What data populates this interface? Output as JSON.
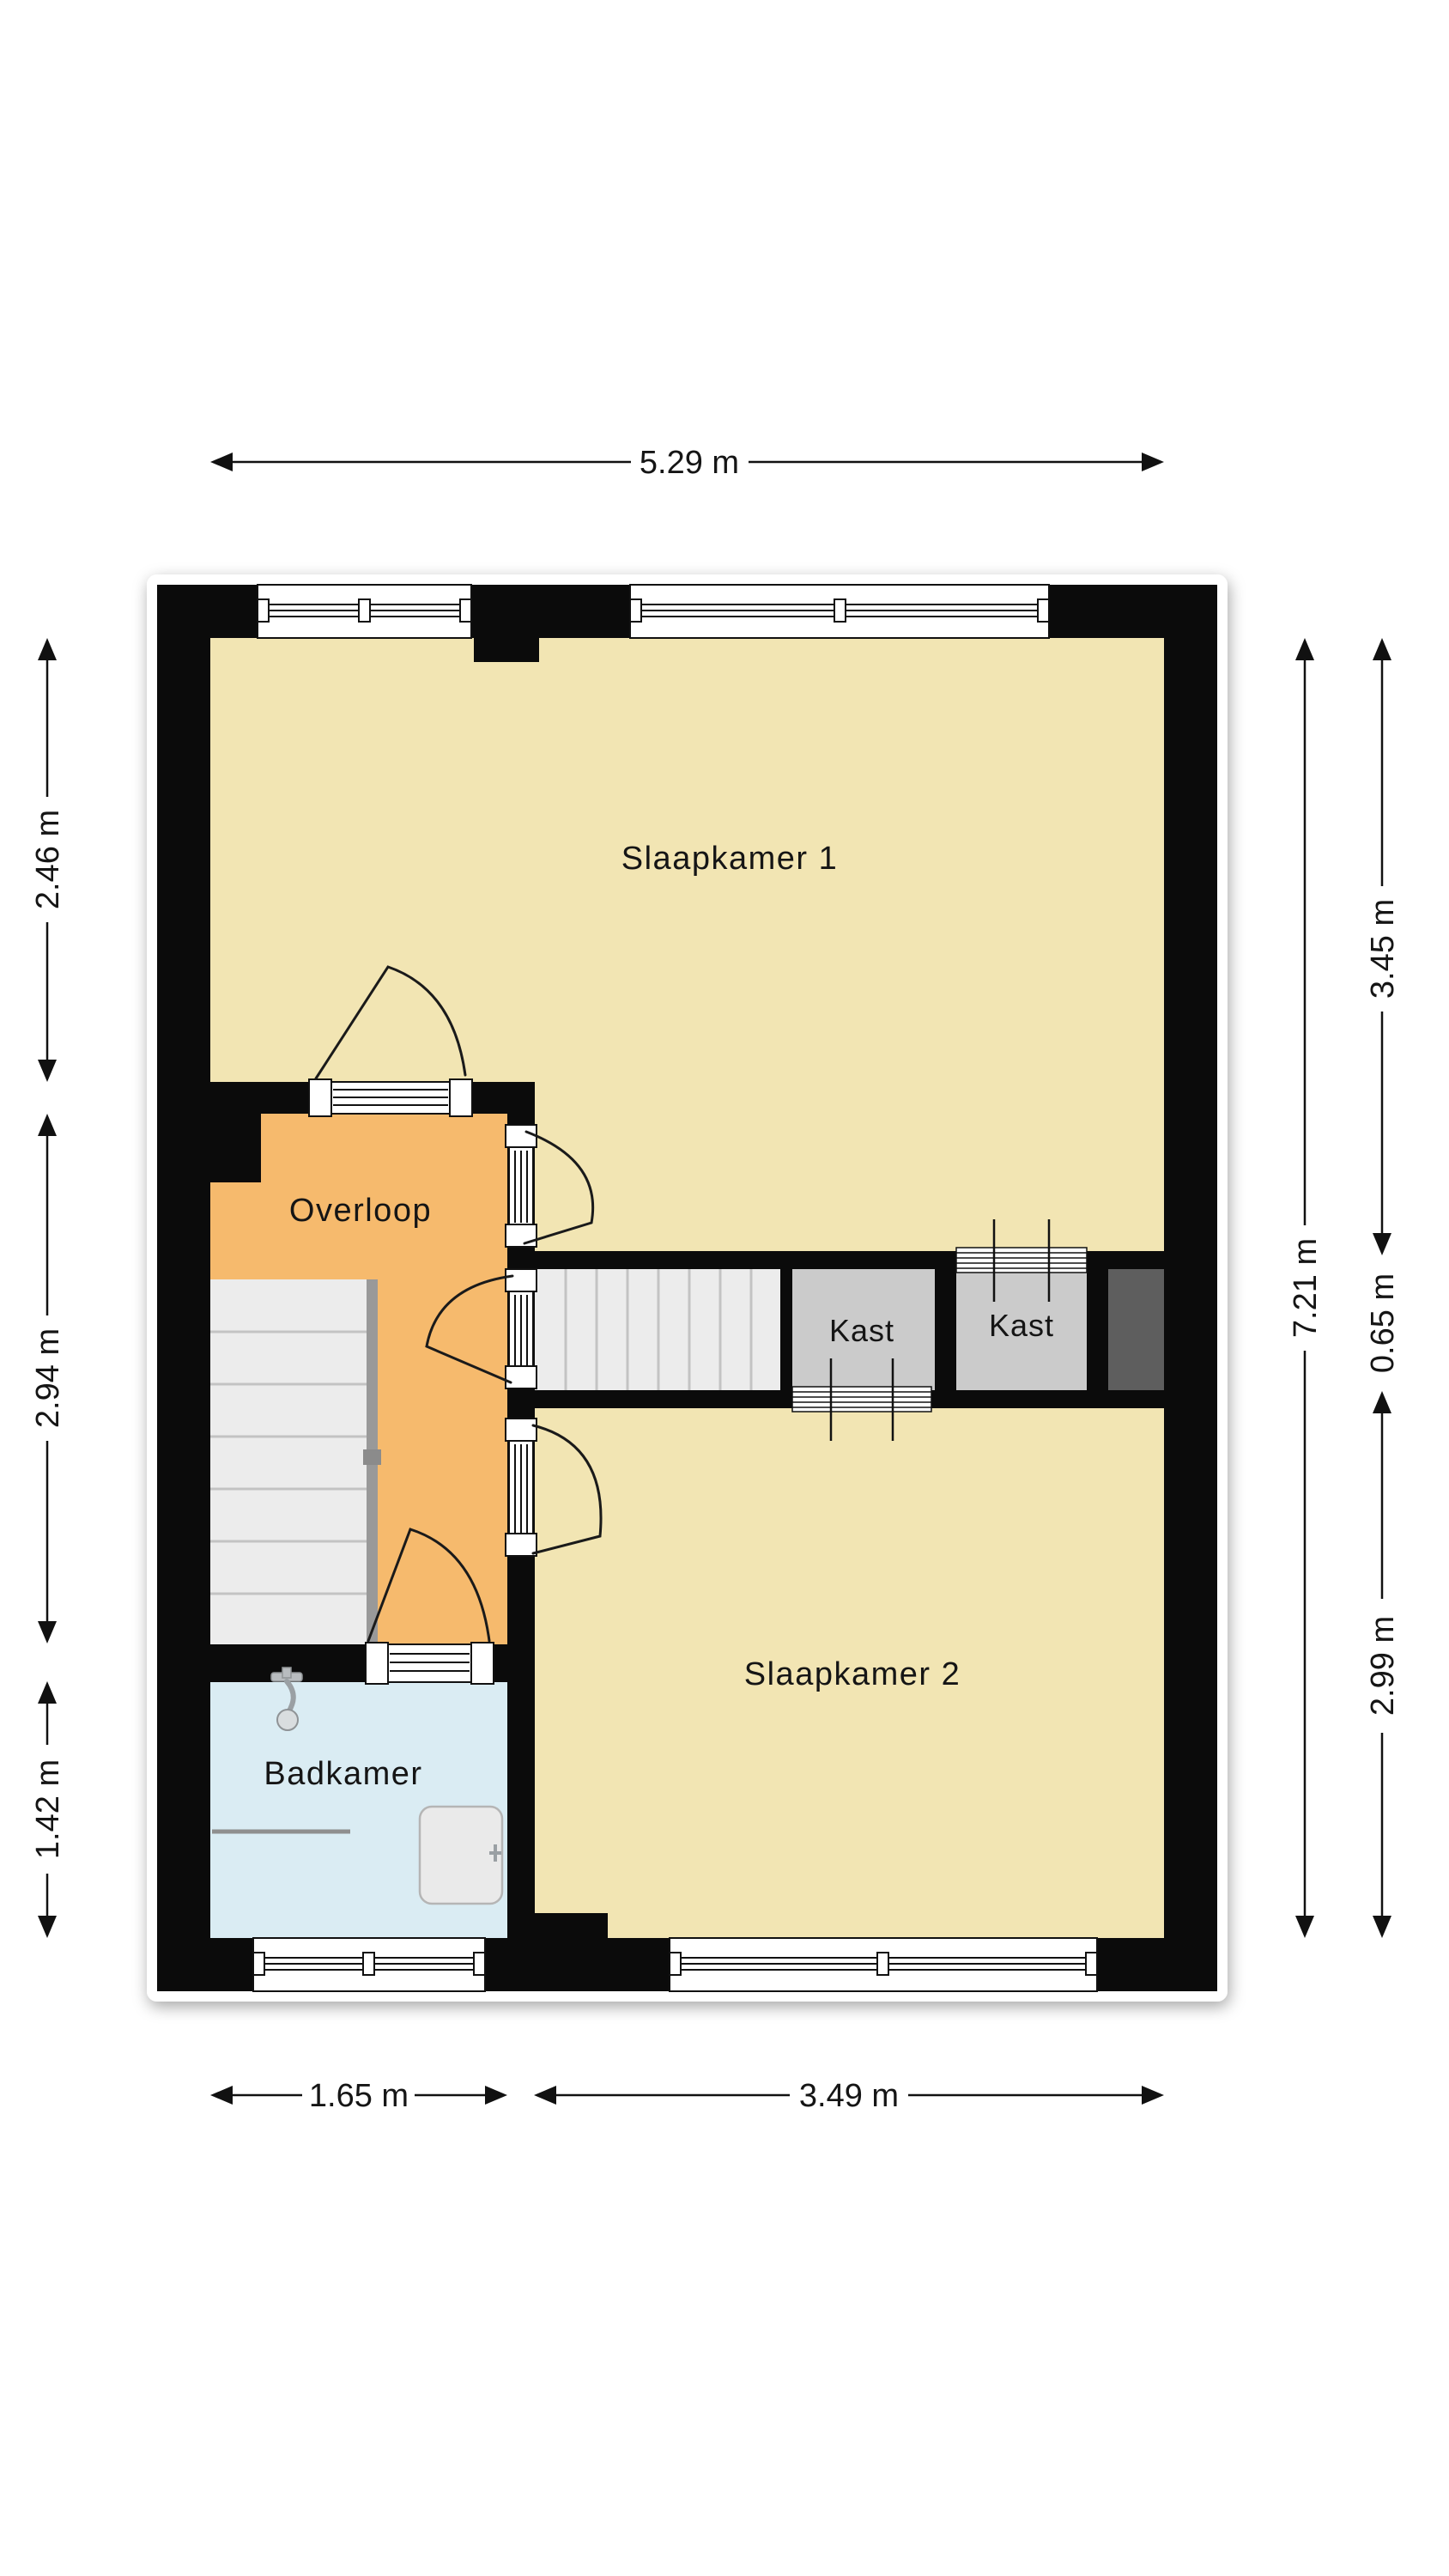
{
  "floorplan": {
    "rooms": {
      "slaapkamer1": "Slaapkamer 1",
      "slaapkamer2": "Slaapkamer 2",
      "overloop": "Overloop",
      "badkamer": "Badkamer",
      "kast1": "Kast",
      "kast2": "Kast"
    },
    "dimensions": {
      "total_width": "5.29 m",
      "total_height": "7.21 m",
      "left_top": "2.46 m",
      "left_middle": "2.94 m",
      "left_bottom": "1.42 m",
      "right_top": "3.45 m",
      "right_middle": "0.65 m",
      "right_bottom": "2.99 m",
      "bottom_left": "1.65 m",
      "bottom_right": "3.49 m"
    },
    "colors": {
      "wall": "#0b0b0b",
      "bedroom_floor": "#f2e5b3",
      "landing_floor": "#f6ba6d",
      "bathroom_floor": "#daecf3",
      "closet_floor": "#cbcbcb",
      "shaft": "#5e5e5e",
      "stairs": "#ececec",
      "handrail": "#999999",
      "fixture": "#a9adb0"
    }
  }
}
